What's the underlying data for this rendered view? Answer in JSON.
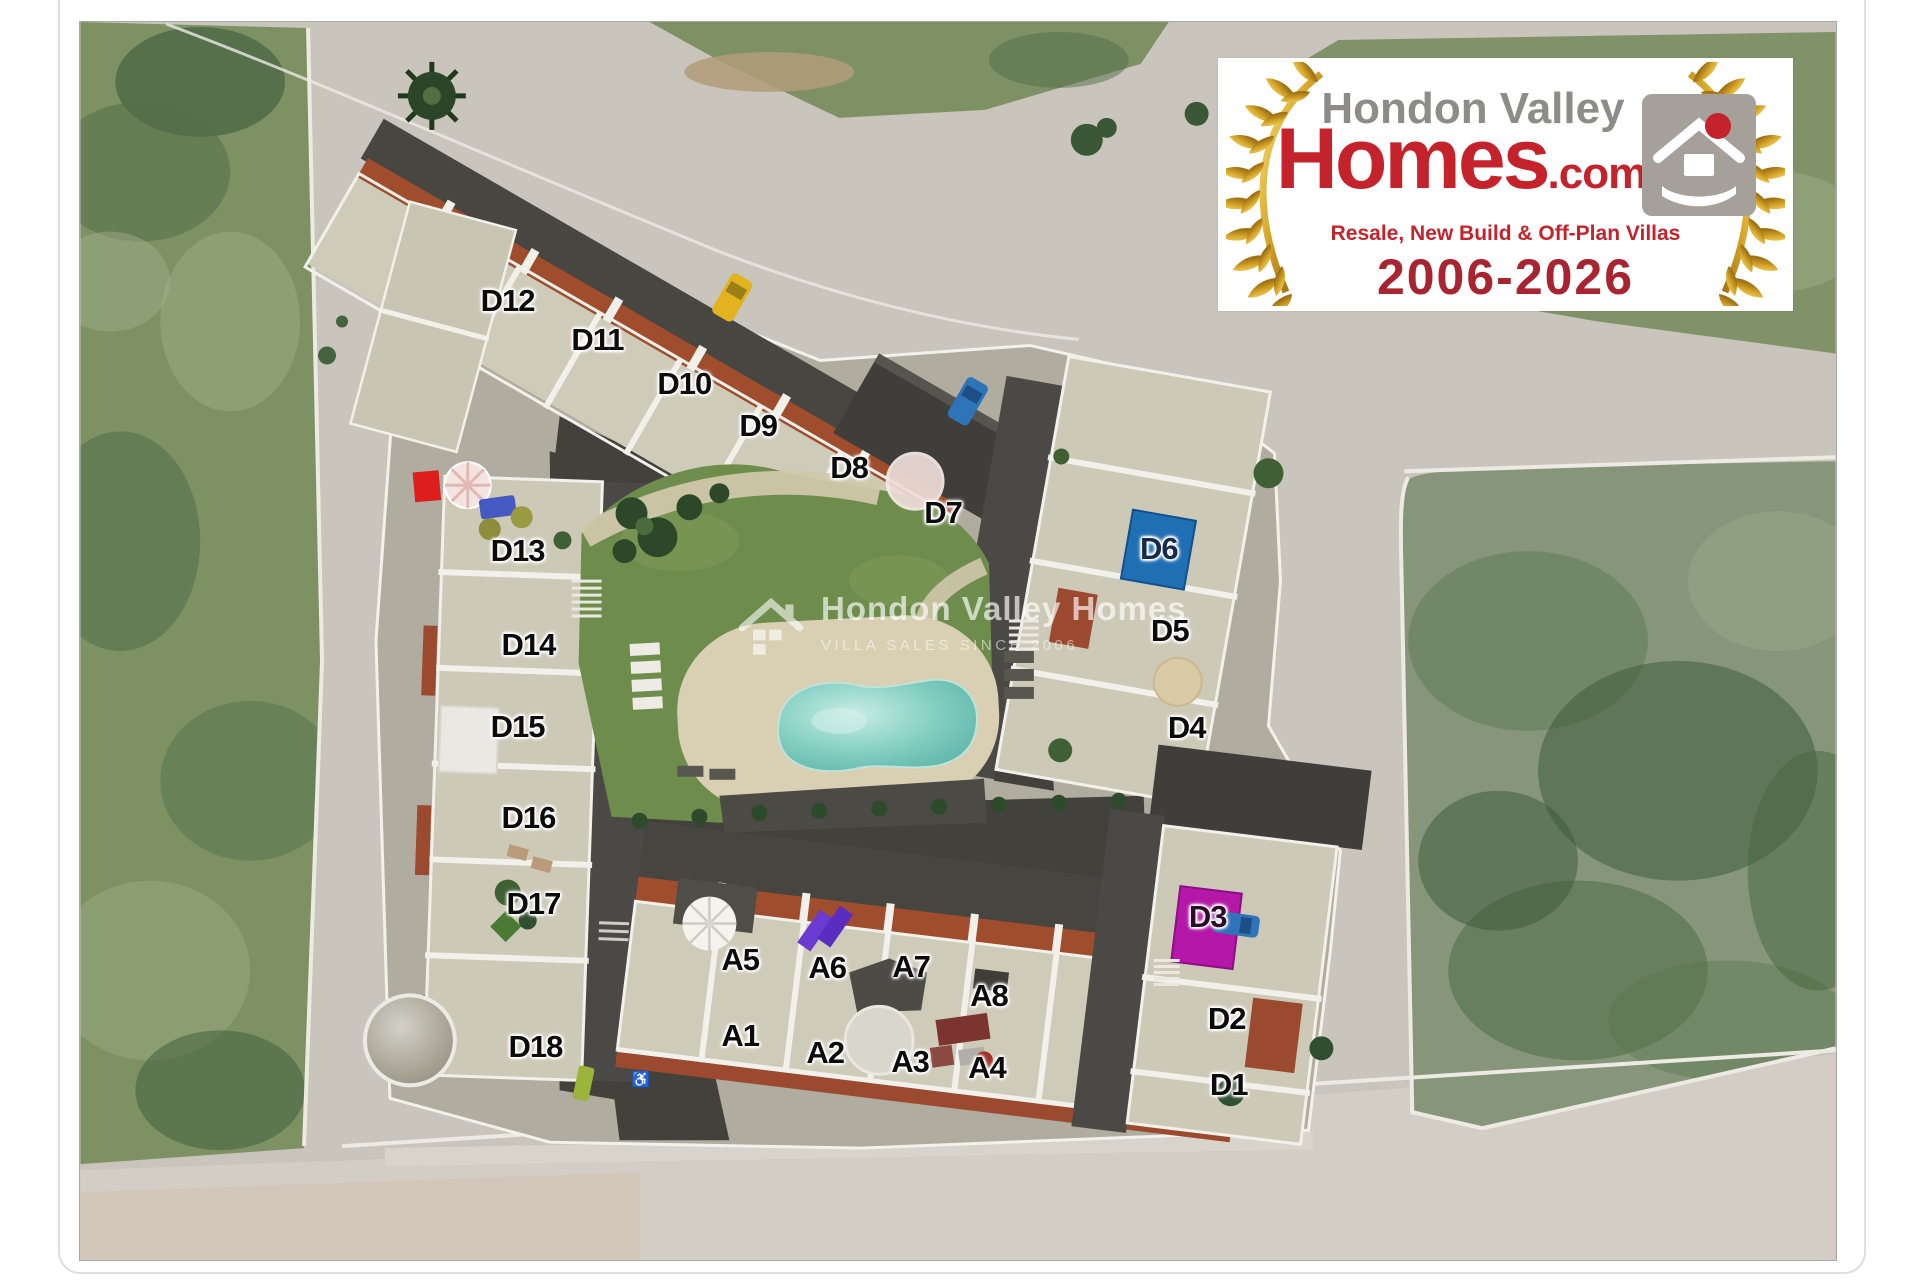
{
  "logo": {
    "line1": "Hondon Valley",
    "line2": "Homes",
    "suffix": ".com",
    "tagline": "Resale, New Build & Off-Plan Villas",
    "years": "2006-2026",
    "colors": {
      "name_gray": "#8e8c8a",
      "red": "#c4232b",
      "years_red": "#a82431",
      "gold": "#c9961a"
    }
  },
  "watermark": {
    "title": "Hondon Valley Homes",
    "subtitle": "VILLA SALES SINCE 2006"
  },
  "site_plan": {
    "marker_colors": {
      "d6_marker": "#1f6fb5",
      "d3_marker": "#b517a8"
    },
    "units": [
      {
        "id": "D12",
        "x": 428,
        "y": 279
      },
      {
        "id": "D11",
        "x": 518,
        "y": 319
      },
      {
        "id": "D10",
        "x": 605,
        "y": 363
      },
      {
        "id": "D9",
        "x": 679,
        "y": 405
      },
      {
        "id": "D8",
        "x": 770,
        "y": 447
      },
      {
        "id": "D7",
        "x": 864,
        "y": 492
      },
      {
        "id": "D6",
        "x": 1080,
        "y": 528,
        "c": "#152a4d"
      },
      {
        "id": "D5",
        "x": 1091,
        "y": 610
      },
      {
        "id": "D4",
        "x": 1108,
        "y": 707
      },
      {
        "id": "D13",
        "x": 438,
        "y": 530
      },
      {
        "id": "D14",
        "x": 449,
        "y": 624
      },
      {
        "id": "D15",
        "x": 438,
        "y": 706
      },
      {
        "id": "D16",
        "x": 449,
        "y": 797
      },
      {
        "id": "D17",
        "x": 454,
        "y": 883
      },
      {
        "id": "D18",
        "x": 456,
        "y": 1027
      },
      {
        "id": "A5",
        "x": 661,
        "y": 940
      },
      {
        "id": "A6",
        "x": 748,
        "y": 948
      },
      {
        "id": "A7",
        "x": 832,
        "y": 947
      },
      {
        "id": "A8",
        "x": 910,
        "y": 976
      },
      {
        "id": "A1",
        "x": 661,
        "y": 1016
      },
      {
        "id": "A2",
        "x": 746,
        "y": 1033
      },
      {
        "id": "A3",
        "x": 831,
        "y": 1042
      },
      {
        "id": "A4",
        "x": 908,
        "y": 1048
      },
      {
        "id": "D3",
        "x": 1129,
        "y": 896,
        "c": "#2e0a2a"
      },
      {
        "id": "D2",
        "x": 1148,
        "y": 999
      },
      {
        "id": "D1",
        "x": 1150,
        "y": 1065
      }
    ]
  }
}
